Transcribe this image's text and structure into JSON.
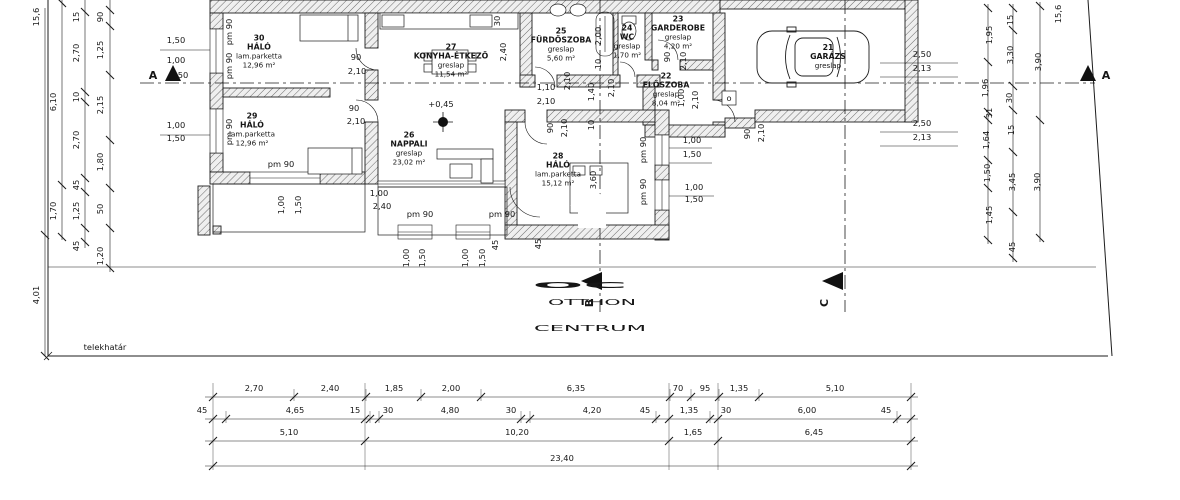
{
  "watermark": {
    "logo": "OC",
    "line1": "OTTHON",
    "line2": "CENTRUM",
    "color": "#c5c5c5"
  },
  "boundary_label": "telekhatár",
  "level_label": "+0,45",
  "colors": {
    "line": "#1c1c1c",
    "wall_fill": "#f0f0f0",
    "hatch": "#6b6b6b",
    "watermark": "#c5c5c5"
  },
  "rooms": [
    {
      "num": "30",
      "name": "HÁLÓ",
      "floor": "lam.parketta",
      "area": "12,96 m²",
      "cx": 259,
      "cy": 51
    },
    {
      "num": "29",
      "name": "HÁLÓ",
      "floor": "lam.parketta",
      "area": "12,96 m²",
      "cx": 252,
      "cy": 129
    },
    {
      "num": "26",
      "name": "NAPPALI",
      "floor": "greslap",
      "area": "23,02 m²",
      "cx": 409,
      "cy": 148
    },
    {
      "num": "27",
      "name": "KONYHA-ÉTKEZŐ",
      "floor": "greslap",
      "area": "11,54 m²",
      "cx": 451,
      "cy": 60
    },
    {
      "num": "25",
      "name": "FÜRDŐSZOBA",
      "floor": "greslap",
      "area": "5,60 m²",
      "cx": 561,
      "cy": 44
    },
    {
      "num": "24",
      "name": "WC",
      "floor": "greslap",
      "area": "1,70 m²",
      "cx": 627,
      "cy": 41
    },
    {
      "num": "23",
      "name": "GARDEROBE",
      "floor": "greslap",
      "area": "4,20 m²",
      "cx": 678,
      "cy": 32
    },
    {
      "num": "22",
      "name": "ELŐSZOBA",
      "floor": "greslap",
      "area": "8,04 m²",
      "cx": 666,
      "cy": 89
    },
    {
      "num": "28",
      "name": "HÁLÓ",
      "floor": "lam.parketta",
      "area": "15,12 m²",
      "cx": 558,
      "cy": 169
    },
    {
      "num": "21",
      "name": "GARÁZS",
      "floor": "greslap",
      "area": "",
      "cx": 828,
      "cy": 56
    }
  ],
  "markers": [
    {
      "t": "A",
      "x": 153,
      "y": 79
    },
    {
      "t": "A",
      "x": 1106,
      "y": 79
    },
    {
      "t": "B",
      "x": 593,
      "y": 303,
      "r": -90
    },
    {
      "t": "C",
      "x": 828,
      "y": 303,
      "r": -90
    }
  ],
  "dims": [
    {
      "t": "2,70",
      "x": 254,
      "y": 391
    },
    {
      "t": "2,40",
      "x": 330,
      "y": 391
    },
    {
      "t": "1,85",
      "x": 394,
      "y": 391
    },
    {
      "t": "2,00",
      "x": 451,
      "y": 391
    },
    {
      "t": "6,35",
      "x": 576,
      "y": 391
    },
    {
      "t": "70",
      "x": 678,
      "y": 391
    },
    {
      "t": "95",
      "x": 705,
      "y": 391
    },
    {
      "t": "1,35",
      "x": 739,
      "y": 391
    },
    {
      "t": "5,10",
      "x": 835,
      "y": 391
    },
    {
      "t": "45",
      "x": 202,
      "y": 413
    },
    {
      "t": "4,65",
      "x": 295,
      "y": 413
    },
    {
      "t": "15",
      "x": 355,
      "y": 413
    },
    {
      "t": "30",
      "x": 388,
      "y": 413
    },
    {
      "t": "4,80",
      "x": 450,
      "y": 413
    },
    {
      "t": "30",
      "x": 511,
      "y": 413
    },
    {
      "t": "4,20",
      "x": 592,
      "y": 413
    },
    {
      "t": "45",
      "x": 645,
      "y": 413
    },
    {
      "t": "1,35",
      "x": 689,
      "y": 413
    },
    {
      "t": "30",
      "x": 726,
      "y": 413
    },
    {
      "t": "6,00",
      "x": 807,
      "y": 413
    },
    {
      "t": "45",
      "x": 886,
      "y": 413
    },
    {
      "t": "5,10",
      "x": 289,
      "y": 435
    },
    {
      "t": "10,20",
      "x": 517,
      "y": 435
    },
    {
      "t": "1,65",
      "x": 693,
      "y": 435
    },
    {
      "t": "6,45",
      "x": 814,
      "y": 435
    },
    {
      "t": "23,40",
      "x": 562,
      "y": 461
    },
    {
      "t": "15,6",
      "x": 39,
      "y": 17,
      "r": -90
    },
    {
      "t": "4,01",
      "x": 39,
      "y": 295,
      "r": -90
    },
    {
      "t": "6,10",
      "x": 56,
      "y": 102,
      "r": -90
    },
    {
      "t": "1,70",
      "x": 56,
      "y": 211,
      "r": -90
    },
    {
      "t": "15",
      "x": 79,
      "y": 17,
      "r": -90
    },
    {
      "t": "2,70",
      "x": 79,
      "y": 53,
      "r": -90
    },
    {
      "t": "10",
      "x": 79,
      "y": 97,
      "r": -90
    },
    {
      "t": "2,70",
      "x": 79,
      "y": 140,
      "r": -90
    },
    {
      "t": "45",
      "x": 79,
      "y": 185,
      "r": -90
    },
    {
      "t": "1,25",
      "x": 79,
      "y": 211,
      "r": -90
    },
    {
      "t": "45",
      "x": 79,
      "y": 246,
      "r": -90
    },
    {
      "t": "90",
      "x": 103,
      "y": 17,
      "r": -90
    },
    {
      "t": "1,25",
      "x": 103,
      "y": 50,
      "r": -90
    },
    {
      "t": "2,15",
      "x": 103,
      "y": 105,
      "r": -90
    },
    {
      "t": "1,80",
      "x": 103,
      "y": 162,
      "r": -90
    },
    {
      "t": "50",
      "x": 103,
      "y": 209,
      "r": -90
    },
    {
      "t": "1,20",
      "x": 103,
      "y": 256,
      "r": -90
    },
    {
      "t": "1,50",
      "x": 176,
      "y": 43
    },
    {
      "t": "1,00",
      "x": 176,
      "y": 63
    },
    {
      "t": "50",
      "x": 183,
      "y": 78
    },
    {
      "t": "1,00",
      "x": 176,
      "y": 128
    },
    {
      "t": "1,50",
      "x": 176,
      "y": 141
    },
    {
      "t": "pm 90",
      "x": 232,
      "y": 32,
      "r": -90
    },
    {
      "t": "pm 90",
      "x": 232,
      "y": 66,
      "r": -90
    },
    {
      "t": "pm 90",
      "x": 232,
      "y": 132,
      "r": -90
    },
    {
      "t": "pm 90",
      "x": 281,
      "y": 167
    },
    {
      "t": "pm 90",
      "x": 420,
      "y": 217
    },
    {
      "t": "pm 90",
      "x": 502,
      "y": 217
    },
    {
      "t": "pm 90",
      "x": 646,
      "y": 150,
      "r": -90
    },
    {
      "t": "pm 90",
      "x": 646,
      "y": 192,
      "r": -90
    },
    {
      "t": "90",
      "x": 356,
      "y": 60
    },
    {
      "t": "2,10",
      "x": 357,
      "y": 74
    },
    {
      "t": "90",
      "x": 354,
      "y": 111
    },
    {
      "t": "2,10",
      "x": 356,
      "y": 124
    },
    {
      "t": "1,10",
      "x": 546,
      "y": 90
    },
    {
      "t": "2,10",
      "x": 546,
      "y": 104
    },
    {
      "t": "2,10",
      "x": 570,
      "y": 81,
      "r": -90
    },
    {
      "t": "2,00",
      "x": 601,
      "y": 36,
      "r": -90
    },
    {
      "t": "10",
      "x": 601,
      "y": 64,
      "r": -90
    },
    {
      "t": "1,40",
      "x": 594,
      "y": 92,
      "r": -90
    },
    {
      "t": "2,10",
      "x": 614,
      "y": 88,
      "r": -90
    },
    {
      "t": "90",
      "x": 670,
      "y": 57,
      "r": -90
    },
    {
      "t": "2,10",
      "x": 686,
      "y": 61,
      "r": -90
    },
    {
      "t": "1,00",
      "x": 684,
      "y": 98,
      "r": -90
    },
    {
      "t": "2,10",
      "x": 698,
      "y": 100,
      "r": -90
    },
    {
      "t": "90",
      "x": 750,
      "y": 134,
      "r": -90
    },
    {
      "t": "2,10",
      "x": 764,
      "y": 133,
      "r": -90
    },
    {
      "t": "90",
      "x": 553,
      "y": 128,
      "r": -90
    },
    {
      "t": "2,10",
      "x": 567,
      "y": 128,
      "r": -90
    },
    {
      "t": "10",
      "x": 594,
      "y": 125,
      "r": -90
    },
    {
      "t": "3,60",
      "x": 596,
      "y": 180,
      "r": -90
    },
    {
      "t": "30",
      "x": 500,
      "y": 21,
      "r": -90
    },
    {
      "t": "2,40",
      "x": 506,
      "y": 52,
      "r": -90
    },
    {
      "t": "1,00",
      "x": 692,
      "y": 143
    },
    {
      "t": "1,50",
      "x": 692,
      "y": 157
    },
    {
      "t": "1,00",
      "x": 694,
      "y": 190
    },
    {
      "t": "1,50",
      "x": 694,
      "y": 202
    },
    {
      "t": "2,50",
      "x": 922,
      "y": 57
    },
    {
      "t": "2,13",
      "x": 922,
      "y": 71
    },
    {
      "t": "2,50",
      "x": 922,
      "y": 126
    },
    {
      "t": "2,13",
      "x": 922,
      "y": 140
    },
    {
      "t": "1,95",
      "x": 992,
      "y": 35,
      "r": -90
    },
    {
      "t": "1,96",
      "x": 988,
      "y": 88,
      "r": -90
    },
    {
      "t": "31",
      "x": 992,
      "y": 113,
      "r": -90
    },
    {
      "t": "1,64",
      "x": 989,
      "y": 140,
      "r": -90
    },
    {
      "t": "1,50",
      "x": 990,
      "y": 173,
      "r": -90
    },
    {
      "t": "1,45",
      "x": 992,
      "y": 215,
      "r": -90
    },
    {
      "t": "15",
      "x": 1013,
      "y": 20,
      "r": -90
    },
    {
      "t": "3,30",
      "x": 1013,
      "y": 55,
      "r": -90
    },
    {
      "t": "30",
      "x": 1012,
      "y": 98,
      "r": -90
    },
    {
      "t": "15",
      "x": 1014,
      "y": 130,
      "r": -90
    },
    {
      "t": "3,45",
      "x": 1015,
      "y": 182,
      "r": -90
    },
    {
      "t": "45",
      "x": 1015,
      "y": 247,
      "r": -90
    },
    {
      "t": "3,90",
      "x": 1041,
      "y": 62,
      "r": -90
    },
    {
      "t": "3,90",
      "x": 1040,
      "y": 182,
      "r": -90
    },
    {
      "t": "15,6",
      "x": 1061,
      "y": 14,
      "r": -90
    },
    {
      "t": "1,00",
      "x": 284,
      "y": 205,
      "r": -90
    },
    {
      "t": "1,50",
      "x": 301,
      "y": 205,
      "r": -90
    },
    {
      "t": "1,00",
      "x": 379,
      "y": 196
    },
    {
      "t": "2,40",
      "x": 382,
      "y": 209
    },
    {
      "t": "1,00",
      "x": 409,
      "y": 258,
      "r": -90
    },
    {
      "t": "1,50",
      "x": 425,
      "y": 258,
      "r": -90
    },
    {
      "t": "1,00",
      "x": 468,
      "y": 258,
      "r": -90
    },
    {
      "t": "1,50",
      "x": 485,
      "y": 258,
      "r": -90
    },
    {
      "t": "45",
      "x": 498,
      "y": 245,
      "r": -90
    },
    {
      "t": "45",
      "x": 541,
      "y": 244,
      "r": -90
    },
    {
      "t": "o",
      "x": 729,
      "y": 101
    }
  ]
}
